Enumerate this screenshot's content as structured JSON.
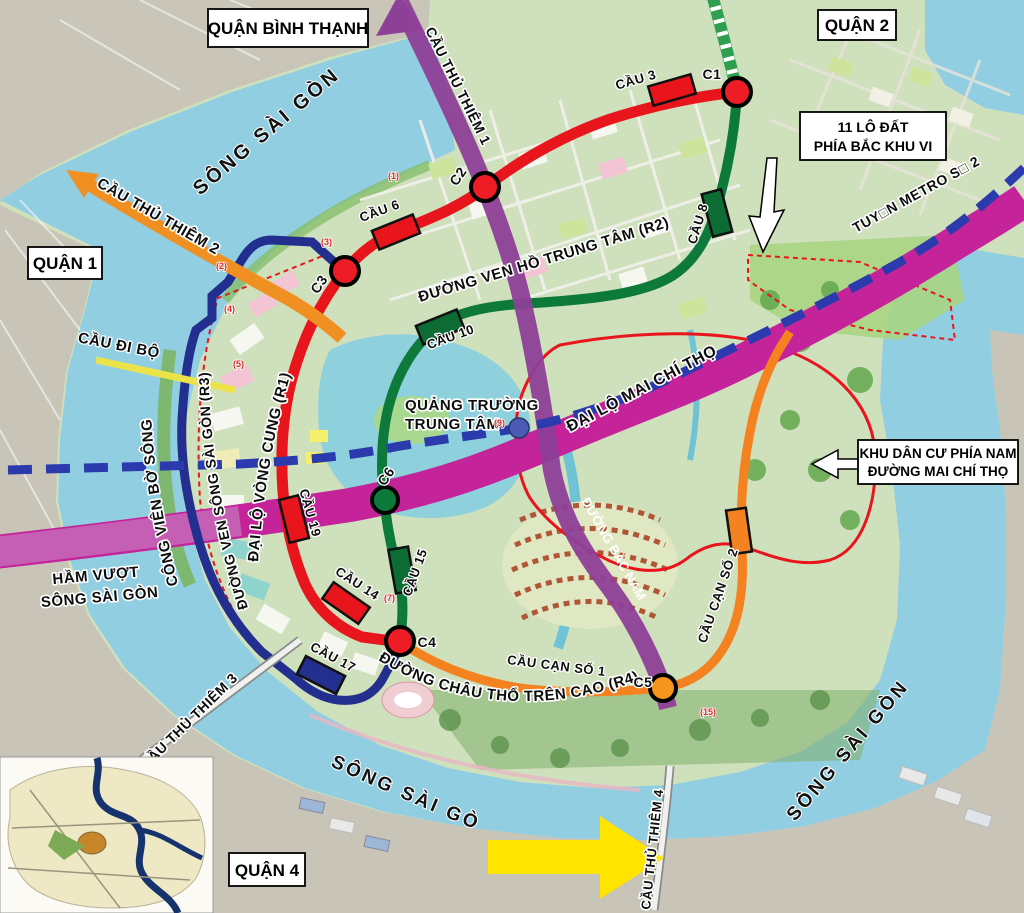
{
  "districts": {
    "binh_thanh": "QUẬN BÌNH THẠNH",
    "quan2": "QUẬN 2",
    "quan1": "QUẬN 1",
    "quan4": "QUẬN 4"
  },
  "rivers": {
    "nw": "SÔNG SÀI GÒN",
    "south": "SÔNG SÀI GÒN",
    "se": "SÔNG SÀI GÒN"
  },
  "routes": {
    "r1": "ĐẠI LỘ VÒNG CUNG (R1)",
    "r2": "ĐƯỜNG VEN HỒ TRUNG TÂM (R2)",
    "r3": "ĐƯỜNG VEN SÔNG SÀI GÒN (R3)",
    "r4": "ĐƯỜNG CHÂU THỔ TRÊN CAO (R4)",
    "mai_chi_tho": "ĐẠI LỘ MAI CHÍ THỌ",
    "bac_nam": "ĐƯỜNG BẮC NAM",
    "metro2": "TUY□N METRO S□ 2",
    "ham_vuot_line1": "HẦM VƯỢT",
    "ham_vuot_line2": "SÔNG SÀI GÒN"
  },
  "bridges": {
    "thu_thiem_1": "CẦU THỦ THIÊM 1",
    "thu_thiem_2": "CẦU THỦ THIÊM 2",
    "thu_thiem_3": "CẦU THỦ THIÊM 3",
    "thu_thiem_4": "CẦU THỦ THIÊM 4",
    "di_bo": "CẦU ĐI BỘ",
    "cau3": "CẦU 3",
    "cau6": "CẦU 6",
    "cau8": "CẦU 8",
    "cau10": "CẦU 10",
    "cau14": "CẦU 14",
    "cau15": "CẦU 15",
    "cau17": "CẦU 17",
    "cau19": "CẦU 19",
    "cau_can_so_1": "CẦU CẠN SỐ 1",
    "cau_can_so_2": "CẦU CẠN SỐ 2"
  },
  "places": {
    "quang_truong_line1": "QUẢNG TRƯỜNG",
    "quang_truong_line2": "TRUNG TÂM",
    "cong_vien_bo_song": "CÔNG VIÊN BỜ SÔNG"
  },
  "callouts": {
    "lo_dat_line1": "11 LÔ ĐẤT",
    "lo_dat_line2": "PHÍA BẮC KHU VI",
    "khu_dan_cu_line1": "KHU DÂN CƯ PHÍA NAM",
    "khu_dan_cu_line2": "ĐƯỜNG MAI CHÍ THỌ"
  },
  "nodes": {
    "c1": "C1",
    "c2": "C2",
    "c3": "C3",
    "c4": "C4",
    "c5": "C5",
    "c6": "C6"
  },
  "parcels": {
    "p1": "(1)",
    "p2": "(2)",
    "p3": "(3)",
    "p4": "(4)",
    "p5": "(5)",
    "p7": "(7)",
    "p9": "(9)",
    "p15": "(15)"
  },
  "colors": {
    "r1_red": "#e8151d",
    "r2_green": "#0d7a3c",
    "r3_navy": "#232f8e",
    "r4_orange": "#f58220",
    "mai_chi_tho_magenta": "#c4239a",
    "metro_blue": "#2b3aad",
    "thu_thiem1_purple": "#8e3f97",
    "thu_thiem2_orange": "#f09022",
    "arrow_yellow": "#ffe400",
    "node_red": "#ee1c25",
    "node_orange": "#f7941d",
    "node_green": "#0d7a3c",
    "station_blue": "#4a5ab5"
  }
}
